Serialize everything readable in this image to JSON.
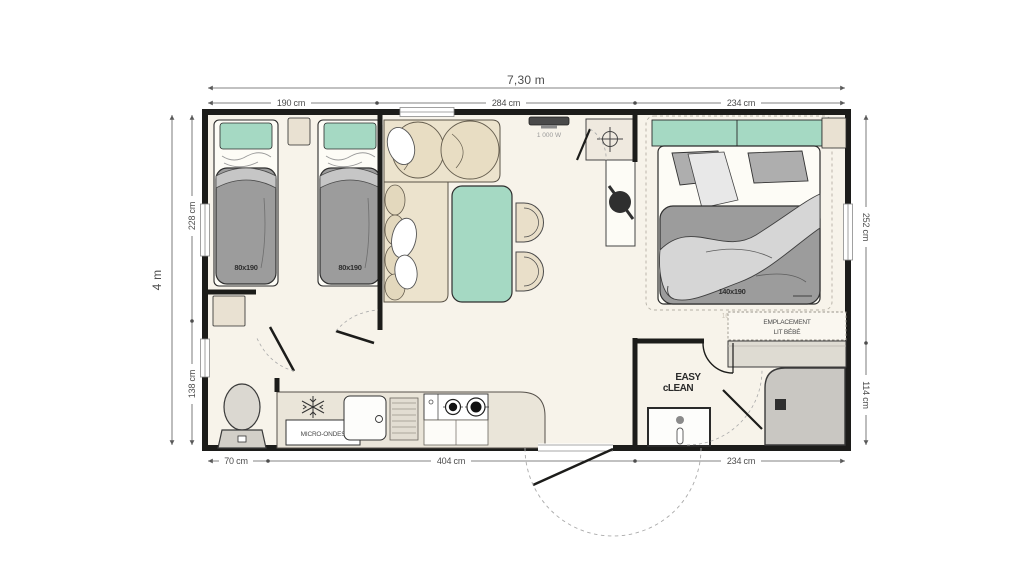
{
  "plan": {
    "width_label": "7,30 m",
    "height_label": "4 m",
    "top_dims": [
      "190 cm",
      "284 cm",
      "234 cm"
    ],
    "left_dims": [
      "228 cm",
      "138 cm"
    ],
    "right_dims": [
      "252 cm",
      "114 cm"
    ],
    "bottom_dims": [
      "70 cm",
      "404 cm",
      "234 cm"
    ]
  },
  "rooms": {
    "twin_bedroom": {
      "bed1_label": "80x190",
      "bed2_label": "80x190"
    },
    "master_bedroom": {
      "bed_label": "140x190",
      "option_label": "160x190",
      "baby_line1": "EMPLACEMENT",
      "baby_line2": "LIT BÉBÉ"
    },
    "kitchen": {
      "microwave_label": "MICRO-ONDES"
    },
    "living": {
      "heater_label": "1 000 W"
    },
    "bathroom": {
      "logo_line1": "EASY",
      "logo_line2": "cLEAN"
    }
  },
  "colors": {
    "wall": "#1c1c1a",
    "floor": "#f7f3ea",
    "accent_teal": "#a5d9c3",
    "sofa_beige": "#ece3cd",
    "bed_gray": "#9c9c9c",
    "blanket_gray": "#d6d6d6",
    "shower_gray": "#c9c7c2",
    "dim_line": "#5a5a5a"
  }
}
